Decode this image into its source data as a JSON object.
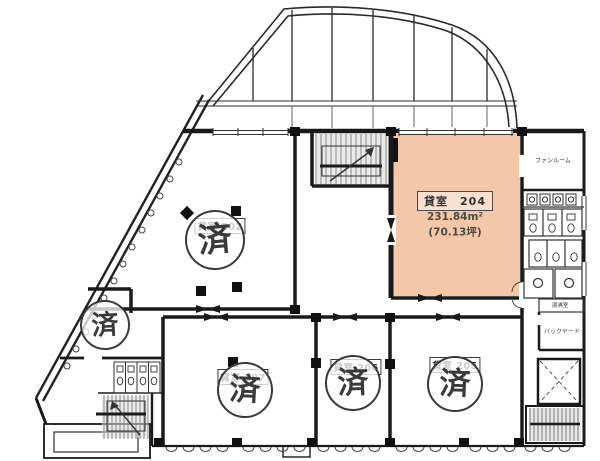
{
  "plan": {
    "colors": {
      "highlight": "#f4c7a9",
      "wall": "#1a1a1a",
      "stamp_ink": "#3a3a3a"
    },
    "stamp_text": "済",
    "featured_room": {
      "label": "貸室　204",
      "area_m2": "231.84m²",
      "area_tsubo": "(70.13坪)"
    },
    "rooms": {
      "r202": {
        "label": "貸室 202"
      },
      "r205": {
        "label": "貸室 205"
      },
      "r206": {
        "label": "貸室 206"
      },
      "r207": {
        "label": "貸室 207"
      }
    },
    "service": {
      "fan_room": "ファンルーム",
      "hot_water": "湯沸室",
      "backyard": "バックヤード"
    }
  }
}
